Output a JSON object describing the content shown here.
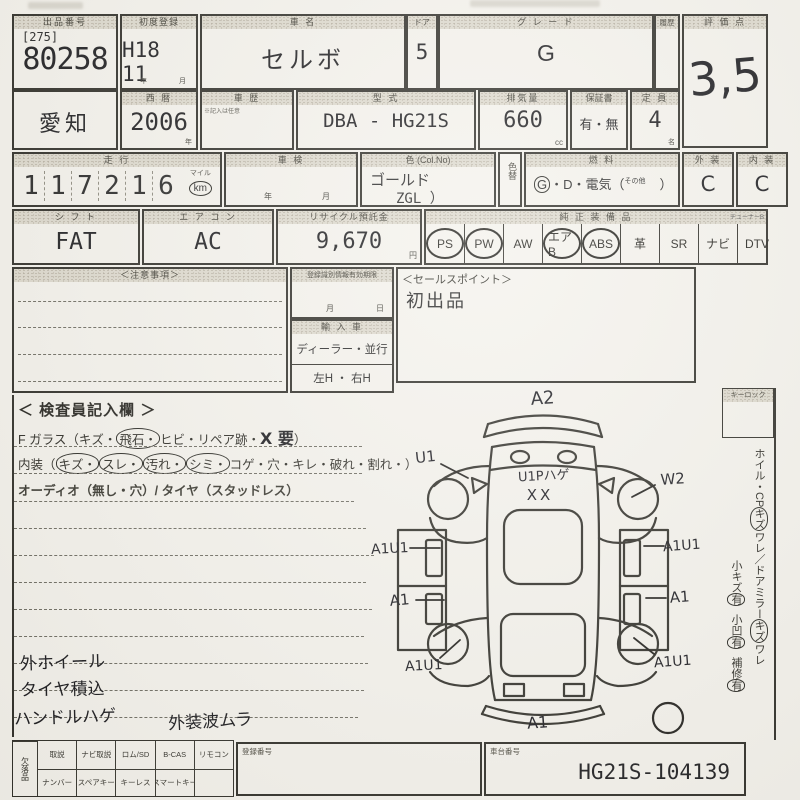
{
  "header": {
    "lot_label": "出品番号",
    "lot_bracket": "[275]",
    "lot_number": "80258",
    "first_reg_label": "初度登録",
    "first_reg_value": "H18 11",
    "first_reg_unit_year": "年",
    "first_reg_unit_month": "月",
    "name_label": "車  名",
    "name_value": "セルボ",
    "door_label": "ドア",
    "door_value": "5",
    "grade_label": "グ レ ー ド",
    "grade_value": "G",
    "history_label": "履歴",
    "score_label": "評 価 点",
    "score_value": "3,5"
  },
  "row2": {
    "prefecture": "愛知",
    "year_label": "西 暦",
    "year_value": "2006",
    "year_unit": "年",
    "history_label": "車 歴",
    "history_note": "※記入は任意",
    "model_label": "型  式",
    "model_value": "DBA - HG21S",
    "disp_label": "排気量",
    "disp_value": "660",
    "disp_unit": "cc",
    "warranty_label": "保証書",
    "warranty_value": "有・無",
    "capacity_label": "定 員",
    "capacity_value": "4",
    "capacity_unit": "名"
  },
  "row3": {
    "mileage_label": "走  行",
    "digits": [
      "1",
      "1",
      "7",
      "2",
      "1",
      "6"
    ],
    "unit_top": "マイル",
    "unit_bottom": "km",
    "shaken_label": "車  検",
    "shaken_unit_year": "年",
    "shaken_unit_month": "月",
    "color_label": "色 (Col.No)",
    "color_value": "ゴールド",
    "color_code": "ZGL ）",
    "color_change_label": "色替",
    "fuel_label": "燃  料",
    "fuel_g": "G",
    "fuel_g_circled": true,
    "fuel_rest": "・D・電気（",
    "fuel_other": "その他",
    "fuel_close": "）",
    "ext_label": "外 装",
    "ext_value": "C",
    "int_label": "内 装",
    "int_value": "C"
  },
  "row4": {
    "shift_label": "シ フ ト",
    "shift_value": "FAT",
    "ac_label": "エ ア コ ン",
    "ac_value": "AC",
    "recycle_label": "リサイクル預託金",
    "recycle_value": "9,670",
    "recycle_unit": "円",
    "equip_label": "純 正 装 備 品",
    "equip_note": "チューナーB",
    "equipment": [
      {
        "label": "PS",
        "circled": true
      },
      {
        "label": "PW",
        "circled": true
      },
      {
        "label": "AW",
        "circled": false
      },
      {
        "label": "エアB",
        "circled": true
      },
      {
        "label": "ABS",
        "circled": true
      },
      {
        "label": "革",
        "circled": false
      },
      {
        "label": "SR",
        "circled": false
      },
      {
        "label": "ナビ",
        "circled": false
      },
      {
        "label": "DTV",
        "circled": false
      }
    ]
  },
  "middle": {
    "caution_label": "＜注意事項＞",
    "reg_label": "登録識別情報有効期限",
    "reg_unit_month": "月",
    "reg_unit_day": "日",
    "import_label": "輸 入 車",
    "import_opt1": "ディーラー・並行",
    "import_opt2": "左H ・ 右H",
    "sales_label": "＜セールスポイント＞",
    "sales_value": "初出品"
  },
  "inspector": {
    "title": "＜ 検査員記入欄 ＞",
    "glass_label": "F ガラス",
    "glass_open": "（",
    "glass_items": [
      {
        "t": "キズ",
        "c": false
      },
      {
        "t": "飛石",
        "c": true
      },
      {
        "t": "ヒビ",
        "c": false
      },
      {
        "t": "リペア跡",
        "c": false
      }
    ],
    "glass_hw": "X 要",
    "glass_close": "）",
    "interior_label": "内装",
    "interior_open": "（",
    "interior_items": [
      {
        "t": "キズ",
        "c": true
      },
      {
        "t": "スレ",
        "c": true
      },
      {
        "t": "汚れ",
        "c": true
      },
      {
        "t": "シミ",
        "c": true
      },
      {
        "t": "コゲ",
        "c": false
      },
      {
        "t": "穴",
        "c": false
      },
      {
        "t": "キレ",
        "c": false
      },
      {
        "t": "破れ",
        "c": false
      },
      {
        "t": "割れ",
        "c": false
      }
    ],
    "interior_close": "）",
    "audio_line": "オーディオ（無し・穴）/ タイヤ（スタッドレス）",
    "notes": [
      "外ホイール",
      "タイヤ積込",
      "ハンドルハゲ",
      "外装波ムラ"
    ]
  },
  "diagram": {
    "labels": [
      "A2",
      "U1",
      "W2",
      "U1Pハゲ",
      "XX",
      "A1U1",
      "A1U1",
      "A1",
      "A1",
      "A1U1",
      "A1U1",
      "A1"
    ]
  },
  "sidebar": {
    "keylock_label": "キーロック",
    "col1": [
      {
        "t": "ホイル・CP",
        "c": false
      },
      {
        "t": "キズ",
        "c": true
      },
      {
        "t": "ワレ",
        "c": false
      },
      {
        "t": "／",
        "c": false
      },
      {
        "t": "ドアミラー",
        "c": false
      },
      {
        "t": "キズ",
        "c": true
      },
      {
        "t": "ワレ",
        "c": false
      }
    ],
    "col2": [
      {
        "t": "小キズ",
        "c": false
      },
      {
        "t": "有",
        "c": true
      },
      {
        "t": "小凹",
        "c": false
      },
      {
        "t": "有",
        "c": true
      },
      {
        "t": "補修",
        "c": false
      },
      {
        "t": "有",
        "c": true
      }
    ]
  },
  "bottom": {
    "missing_label": "欠落品",
    "row1": [
      "取説",
      "ナビ取説",
      "ロム/SD",
      "B-CAS",
      "リモコン"
    ],
    "row2": [
      "ナンバー",
      "スペアキー",
      "キーレス",
      "スマートキー",
      ""
    ],
    "reg_label": "登録番号",
    "chassis_label": "車台番号",
    "chassis_value": "HG21S-104139"
  },
  "colors": {
    "paper": "#f4f2ec",
    "ink": "#2a2923",
    "hand": "#141418"
  }
}
